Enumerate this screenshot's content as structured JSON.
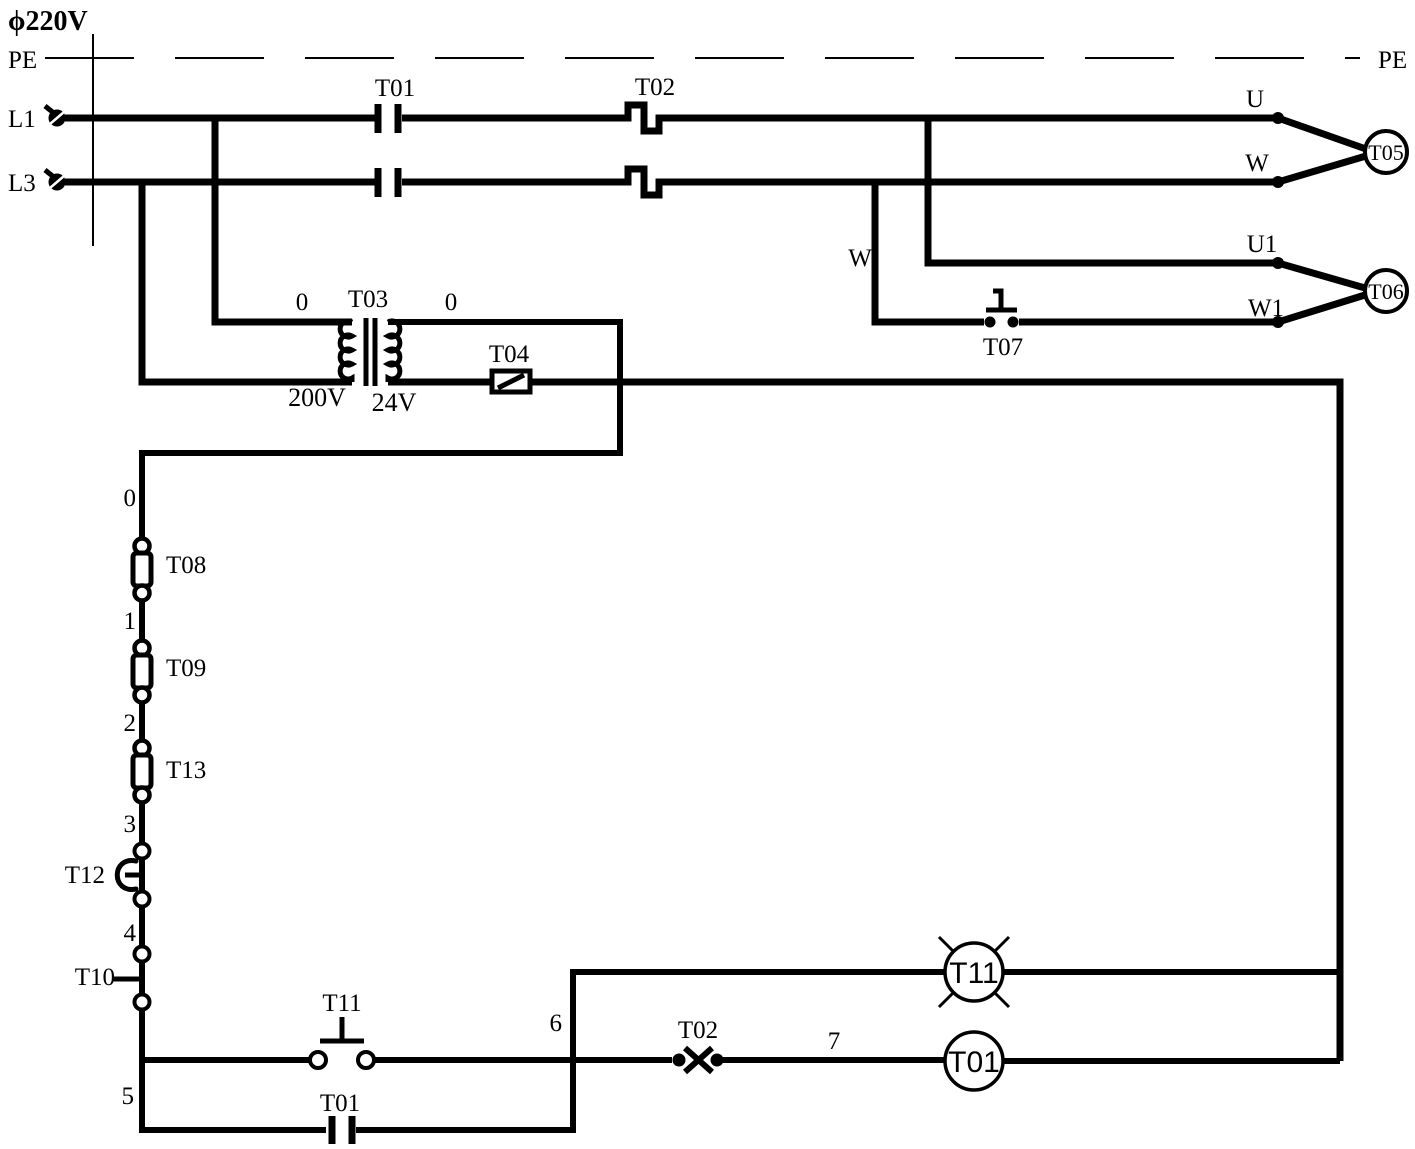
{
  "diagram": {
    "header": {
      "supply_voltage": "ϕ220V",
      "pe_left": "PE",
      "pe_right": "PE",
      "l1": "L1",
      "l3": "L3"
    },
    "power": {
      "main_contact": "T01",
      "overload": "T02",
      "phase_u": "U",
      "phase_w": "W",
      "phase_u1": "U1",
      "phase_w1": "W1",
      "branch_w": "W",
      "motor_high": "T05",
      "motor_low": "T06",
      "speed_button": "T07"
    },
    "transformer": {
      "node_left": "0",
      "name": "T03",
      "node_right": "0",
      "primary_voltage": "200V",
      "secondary_voltage": "24V"
    },
    "control": {
      "fuse_t04": "T04",
      "node_0": "0",
      "fuse_t08": "T08",
      "node_1": "1",
      "fuse_t09": "T09",
      "node_2": "2",
      "fuse_t13": "T13",
      "node_3": "3",
      "estop_t12": "T12",
      "node_4": "4",
      "switch_t10": "T10",
      "node_5": "5",
      "start_button_t11": "T11",
      "hold_contact_t01": "T01",
      "node_6": "6",
      "nc_contact_t02": "T02",
      "node_7": "7",
      "lamp_t11": "T11",
      "coil_t01": "T01"
    }
  }
}
